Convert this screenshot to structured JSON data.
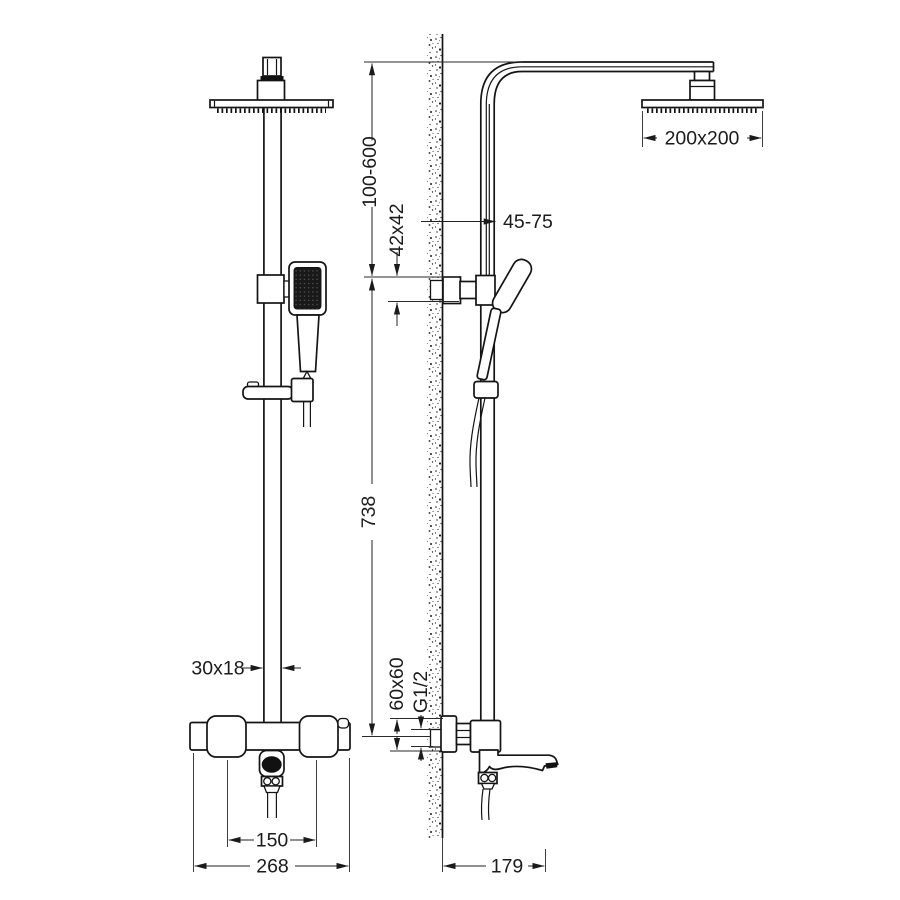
{
  "drawing": {
    "type": "technical-dimension-drawing",
    "subject": "shower-column-with-rain-head-hand-shower-and-bath-mixer",
    "views": {
      "left": "front-view",
      "right": "side-view-at-wall"
    },
    "dimensions": {
      "height_range": "100-600",
      "wall_bracket_section": "42x42",
      "wall_clearance": "45-75",
      "head_size": "200x200",
      "column_height": "738",
      "riser_section": "30x18",
      "inlet_spacing": "150",
      "mixer_width": "268",
      "escutcheon_size": "60x60",
      "inlet_thread": "G1/2",
      "spout_reach": "179"
    },
    "colors": {
      "ink": "#141414",
      "dimension_ink": "#1b1b1b",
      "paper": "#ffffff",
      "dark_fill": "#111111"
    }
  }
}
